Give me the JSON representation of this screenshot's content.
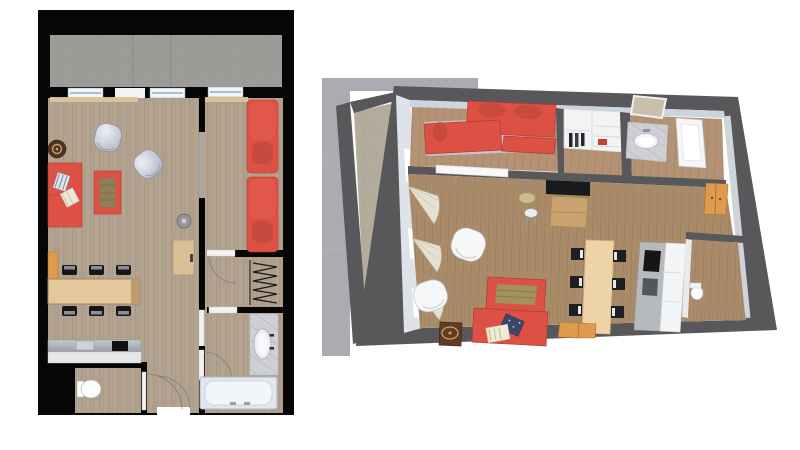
{
  "document": {
    "type": "apartment floor plan sheet",
    "views": [
      {
        "id": "plan-2d",
        "label": "2D top-down apartment floor plan"
      },
      {
        "id": "plan-3d",
        "label": "3D perspective apartment floor plan"
      }
    ],
    "rooms": [
      "balcony",
      "living-room",
      "dining-area",
      "kitchen",
      "wc",
      "hallway",
      "bedroom",
      "closet",
      "bathroom"
    ],
    "furniture": [
      "red-sofa",
      "red-beds",
      "armchairs",
      "rug",
      "side-table",
      "dining-table",
      "chairs",
      "bench",
      "kitchen-counter",
      "cooktop",
      "sink",
      "toilet",
      "bathtub",
      "vanity",
      "mirror",
      "wardrobe",
      "tv",
      "tv-stand",
      "desk",
      "stool",
      "pendant-lamp",
      "wall-cabinet",
      "curtains"
    ]
  },
  "palette": {
    "page-bg": "#ffffff",
    "wall-2d": "#060606",
    "wood-2d": "#b3a492",
    "wood-2d-line": "#a08f7a",
    "concrete-2d": "#9b9b97",
    "concrete-2d-dot": "#8c8c88",
    "red": "#dd5044",
    "red-dark": "#b73a31",
    "red-bright": "#e2574b",
    "rug-center": "#8f7f58",
    "orange": "#de9a4d",
    "cream": "#eed3a9",
    "table-wood": "#e4c89c",
    "silver": "#ccd2dd",
    "steel": "#aeb3b9",
    "white-fixture": "#f2f5f9",
    "marble": "#ced0d6",
    "wall-3d": "#58585a",
    "wall-3d-face": "#ccd5dd",
    "backdrop-3d": "#acabb4",
    "wood-3d": "#aa8c6b",
    "wood-3d-line": "#97795a",
    "wood-3d-light": "#b49374",
    "concrete-3d": "#b3ab9c",
    "tv-black": "#191a1c",
    "cabinet-wood": "#c9a270",
    "pillow-navy": "#3d4668",
    "pillow-cream": "#f0ead8"
  }
}
